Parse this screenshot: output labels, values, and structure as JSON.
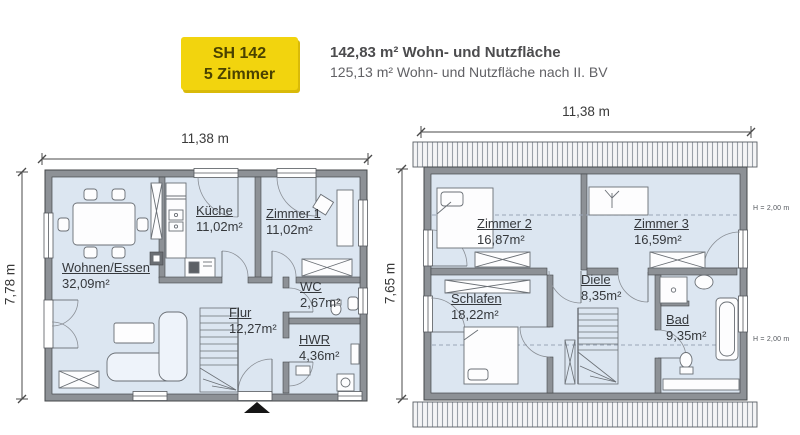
{
  "header": {
    "badge": {
      "model": "SH 142",
      "rooms": "5 Zimmer"
    },
    "area_bold": "142,83 m² Wohn- und Nutzfläche",
    "area_sub": "125,13 m² Wohn- und Nutzfläche nach II. BV"
  },
  "ground_floor": {
    "width_label": "11,38 m",
    "depth_label": "7,78 m",
    "rooms": [
      {
        "name": "Wohnen/Essen",
        "area": "32,09m²"
      },
      {
        "name": "Küche",
        "area": "11,02m²"
      },
      {
        "name": "Zimmer 1",
        "area": "11,02m²"
      },
      {
        "name": "WC",
        "area": "2,67m²"
      },
      {
        "name": "Flur",
        "area": "12,27m²"
      },
      {
        "name": "HWR",
        "area": "4,36m²"
      }
    ]
  },
  "upper_floor": {
    "width_label": "11,38 m",
    "depth_label": "7,65 m",
    "height_markers": [
      "H = 2,00 m",
      "H = 2,00 m"
    ],
    "rooms": [
      {
        "name": "Zimmer 2",
        "area": "16,87m²"
      },
      {
        "name": "Zimmer 3",
        "area": "16,59m²"
      },
      {
        "name": "Schlafen",
        "area": "18,22m²"
      },
      {
        "name": "Diele",
        "area": "8,35m²"
      },
      {
        "name": "Bad",
        "area": "9,35m²"
      }
    ]
  },
  "colors": {
    "floor": "#dce6f1",
    "wall": "#8d9196",
    "badge_bg": "#f2d40e",
    "badge_text": "#4a4200",
    "header_text": "#4c4c4e"
  }
}
